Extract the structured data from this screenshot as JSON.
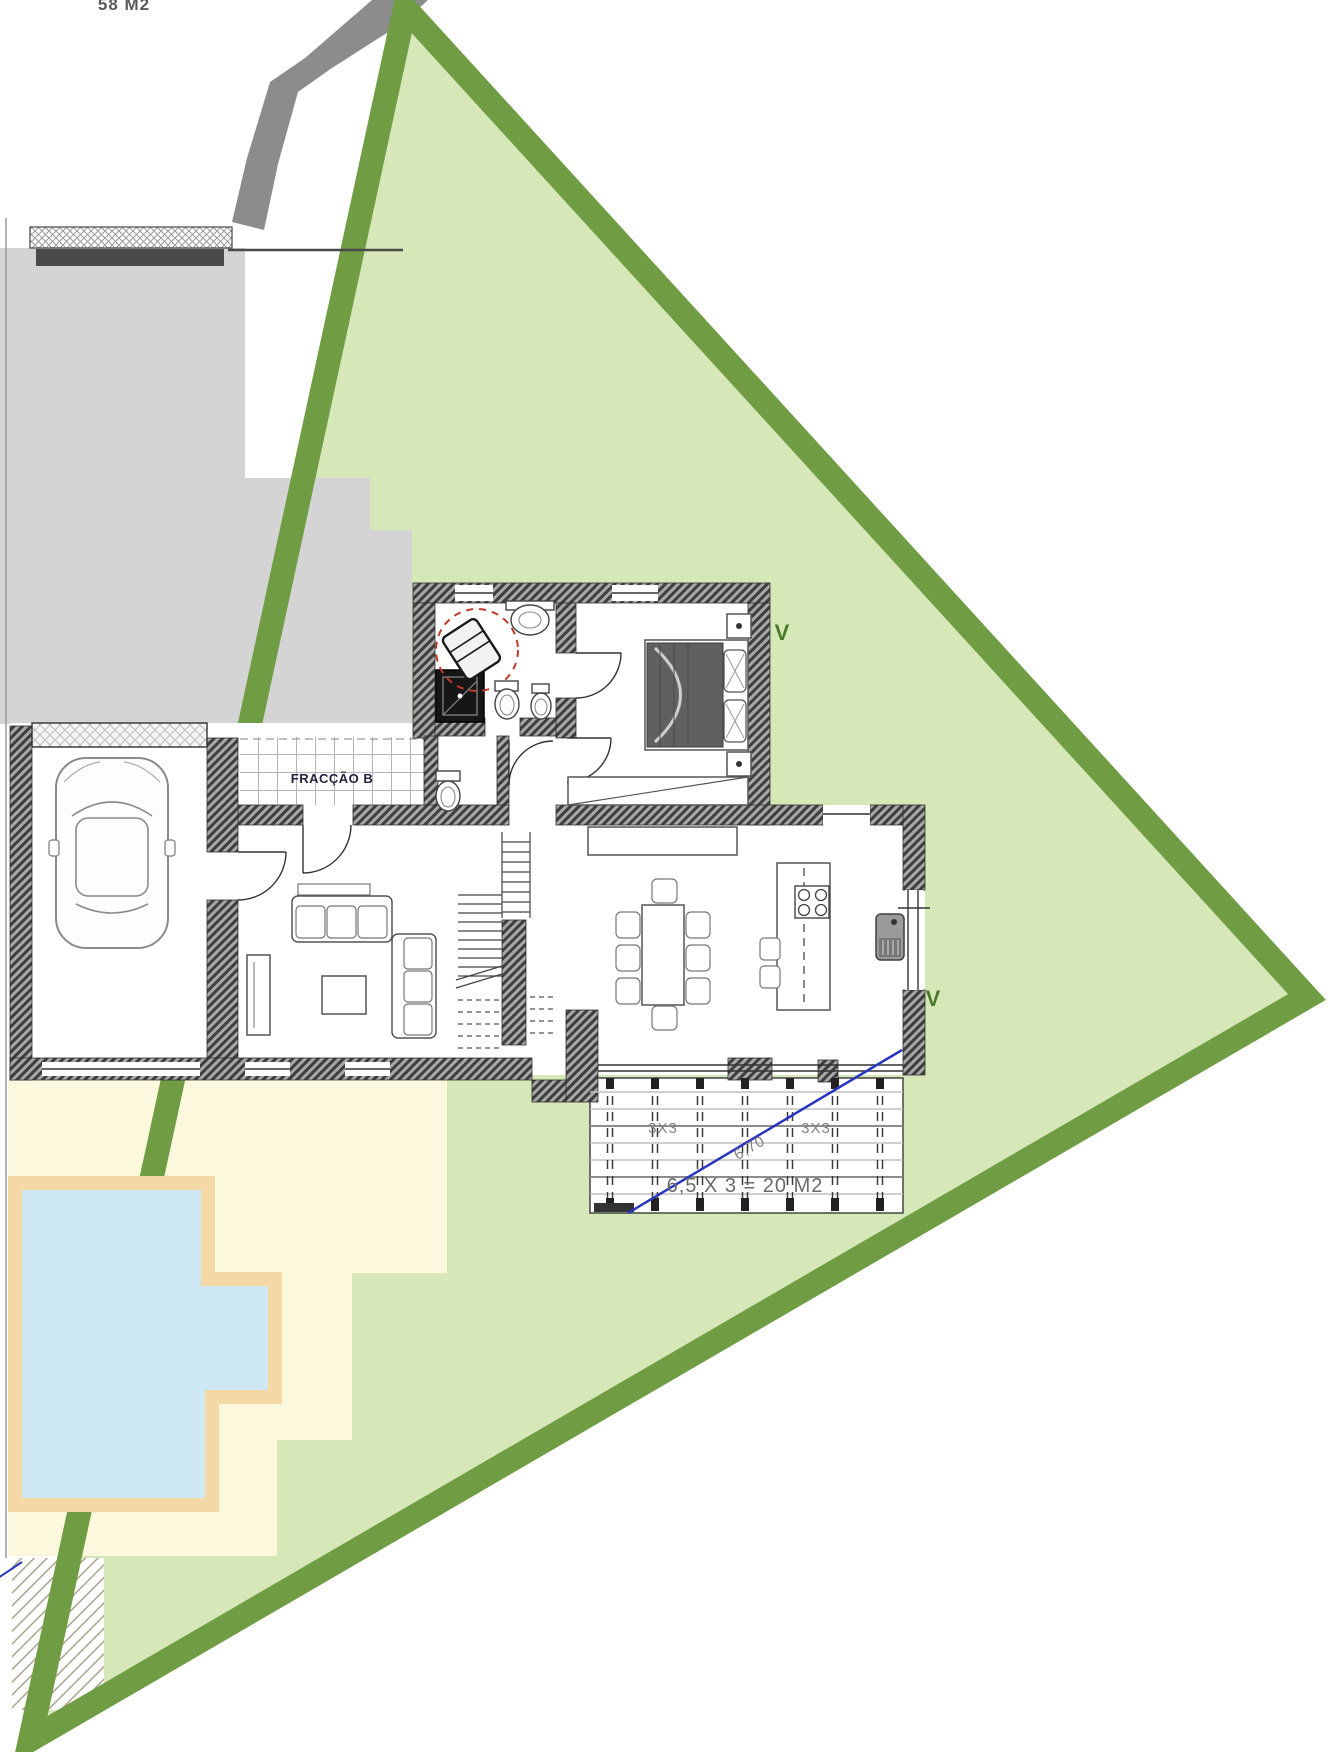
{
  "plan": {
    "type": "residential-site-floor-plan",
    "labels": {
      "lot_area_top": "58 M2",
      "fraction_name": "FRACÇÃO B",
      "vent_marker_1": "V",
      "vent_marker_2": "V",
      "deck_dim_left": "3X3",
      "deck_dim_right": "3X3",
      "deck_diagonal_dim": "6,70",
      "deck_area_formula": "6,5 X 3 = 20 M2"
    },
    "colors": {
      "lawn": "#d6e8b8",
      "lot_border_green": "#709c44",
      "access_road_gray": "#8c8c8c",
      "neighbor_building_gray": "#d4d4d4",
      "patio_cream": "#fcf8dd",
      "pool_water_blue": "#cfe9f4",
      "pool_deck_tan": "#f4d9a6",
      "wall_hatch_dark": "#3e3e3e",
      "marker_green": "#4c7a2c",
      "dimension_blue": "#2a35c0",
      "attention_circle_red": "#c0392b"
    },
    "rooms": [
      "garage",
      "living-room",
      "entry-terrace",
      "hall",
      "wc",
      "bathroom",
      "bedroom",
      "dining-area",
      "kitchen",
      "wood-deck",
      "pool-patio"
    ]
  }
}
